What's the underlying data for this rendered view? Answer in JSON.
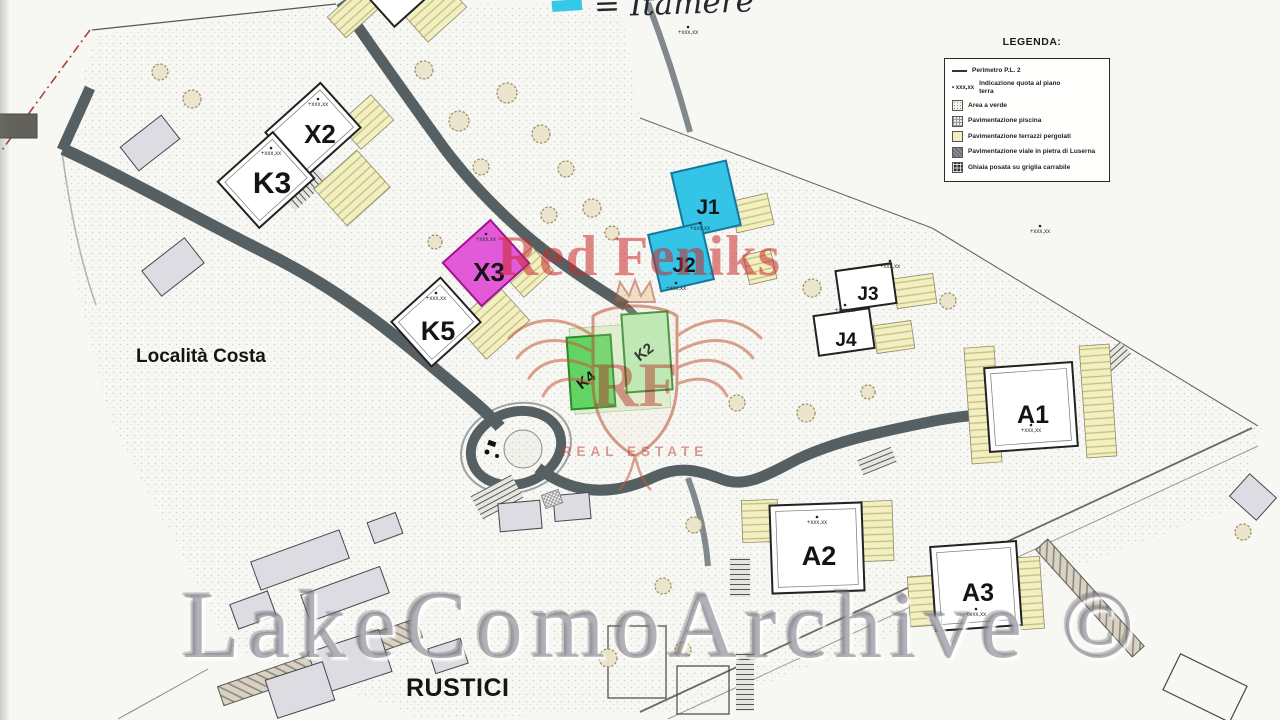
{
  "plan": {
    "quota_text": "+xxx,xx",
    "road_color": "#566063",
    "terrace_color": "#f2efc0",
    "labels": {
      "locality": "Località Costa",
      "rustici": "RUSTICI"
    }
  },
  "buildings": [
    {
      "id": "X2",
      "label": "X2",
      "fill": "#ffffff"
    },
    {
      "id": "K3",
      "label": "K3",
      "fill": "#ffffff"
    },
    {
      "id": "X3",
      "label": "X3",
      "fill": "#e35ad9"
    },
    {
      "id": "K5",
      "label": "K5",
      "fill": "#ffffff"
    },
    {
      "id": "J1",
      "label": "J1",
      "fill": "#33c4e8"
    },
    {
      "id": "J2",
      "label": "J2",
      "fill": "#33c4e8"
    },
    {
      "id": "J3",
      "label": "J3",
      "fill": "#ffffff"
    },
    {
      "id": "J4",
      "label": "J4",
      "fill": "#ffffff"
    },
    {
      "id": "K4",
      "label": "K4",
      "fill": "#63d463"
    },
    {
      "id": "K2",
      "label": "K2",
      "fill": "#b6e9b0"
    },
    {
      "id": "A1",
      "label": "A1",
      "fill": "#ffffff"
    },
    {
      "id": "A2",
      "label": "A2",
      "fill": "#ffffff"
    },
    {
      "id": "A3",
      "label": "A3",
      "fill": "#ffffff"
    }
  ],
  "legend": {
    "title": "LEGENDA:",
    "items": [
      {
        "name": "perimetro",
        "label": "Perimetro P.L. 2"
      },
      {
        "name": "quota",
        "prefix": "xxx,xx",
        "label": "Indicazione quota al piano terra"
      },
      {
        "name": "area-verde",
        "label": "Area a verde"
      },
      {
        "name": "pav-piscina",
        "label": "Pavimentazione piscina"
      },
      {
        "name": "pav-terrazzi",
        "label": "Pavimentazione terrazzi pergolati",
        "color": "#f2efc0"
      },
      {
        "name": "pav-viale",
        "label": "Pavimentazione viale in pietra di Luserna",
        "color": "#6b7276"
      },
      {
        "name": "ghiaia",
        "label": "Ghiaia posata su griglia carrabile",
        "color": "#2e2e2e"
      }
    ]
  },
  "annotations": {
    "handwritten_note": "= Itamere",
    "swatch_color": "#35c8e8"
  },
  "watermarks": {
    "brand": "Red Feniks",
    "monogram": "RF",
    "tagline": "REAL ESTATE",
    "archive": "LakeComoArchive ©",
    "brand_color": "#c03030",
    "archive_color": "#7a7a84"
  }
}
